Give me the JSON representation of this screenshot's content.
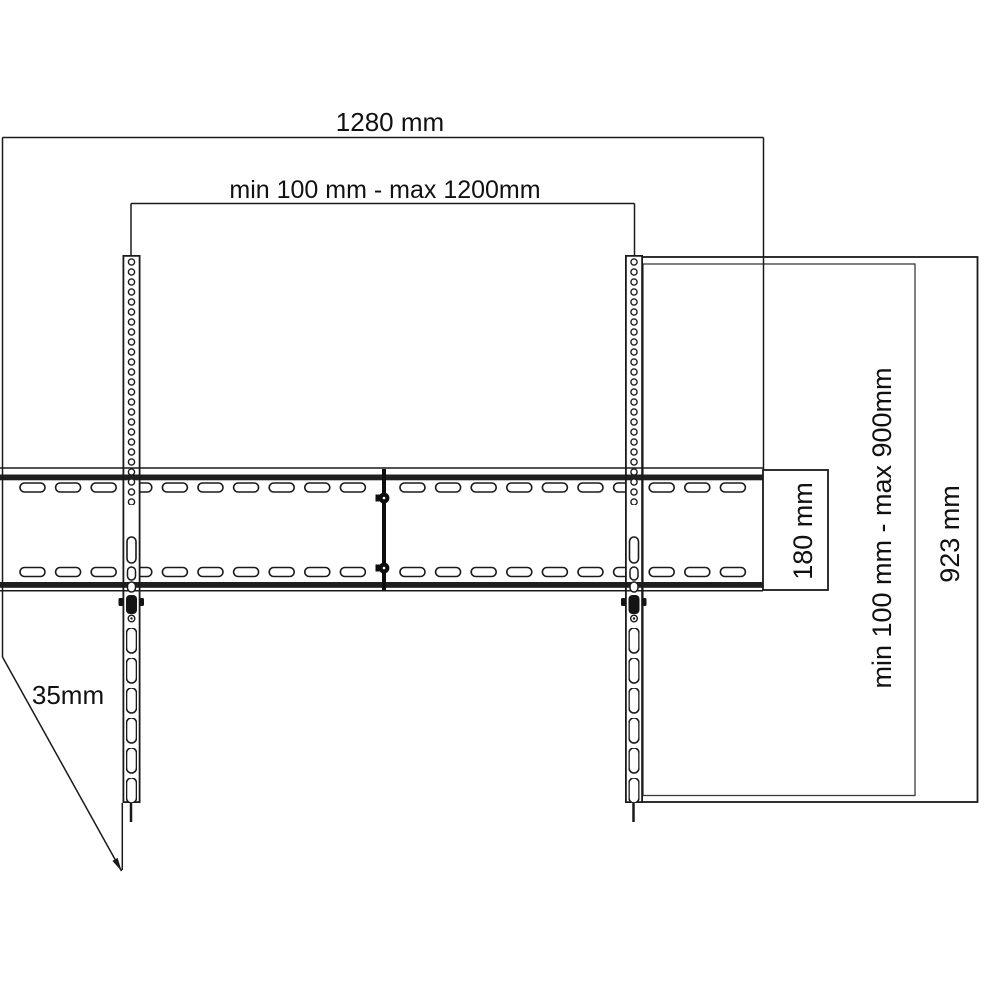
{
  "diagram": {
    "labels": {
      "overall_width": "1280 mm",
      "mount_width_range": "min 100 mm - max 1200mm",
      "mount_height_range": "min 100 mm - max 900mm",
      "overall_height": "923 mm",
      "bar_height": "180 mm",
      "profile_depth": "35mm"
    },
    "colors": {
      "background": "#ffffff",
      "line": "#1a1a1a",
      "band": "#1f1f1f",
      "text": "#111111"
    }
  }
}
